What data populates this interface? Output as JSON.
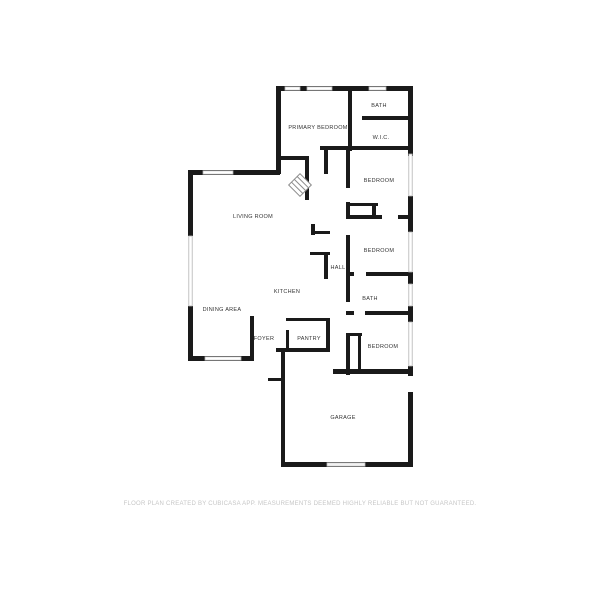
{
  "floor_plan": {
    "rooms": [
      {
        "id": "bath-upper",
        "label": "BATH"
      },
      {
        "id": "primary-bedroom",
        "label": "PRIMARY BEDROOM"
      },
      {
        "id": "wic",
        "label": "W.I.C."
      },
      {
        "id": "bedroom-1",
        "label": "BEDROOM"
      },
      {
        "id": "living-room",
        "label": "LIVING ROOM"
      },
      {
        "id": "bedroom-2",
        "label": "BEDROOM"
      },
      {
        "id": "hall",
        "label": "HALL"
      },
      {
        "id": "kitchen",
        "label": "KITCHEN"
      },
      {
        "id": "bath-lower",
        "label": "BATH"
      },
      {
        "id": "dining-area",
        "label": "DINING AREA"
      },
      {
        "id": "foyer",
        "label": "FOYER"
      },
      {
        "id": "pantry",
        "label": "PANTRY"
      },
      {
        "id": "bedroom-3",
        "label": "BEDROOM"
      },
      {
        "id": "garage",
        "label": "GARAGE"
      }
    ],
    "icons": [
      {
        "name": "fireplace-icon"
      }
    ],
    "disclaimer": "FLOOR PLAN CREATED BY CUBICASA APP. MEASUREMENTS DEEMED HIGHLY RELIABLE BUT NOT GUARANTEED.",
    "colors": {
      "wall": "#1a1a1a",
      "window_border": "#b3b3b3",
      "label": "#333333",
      "disclaimer": "#c6c6c6",
      "background": "#ffffff"
    }
  }
}
